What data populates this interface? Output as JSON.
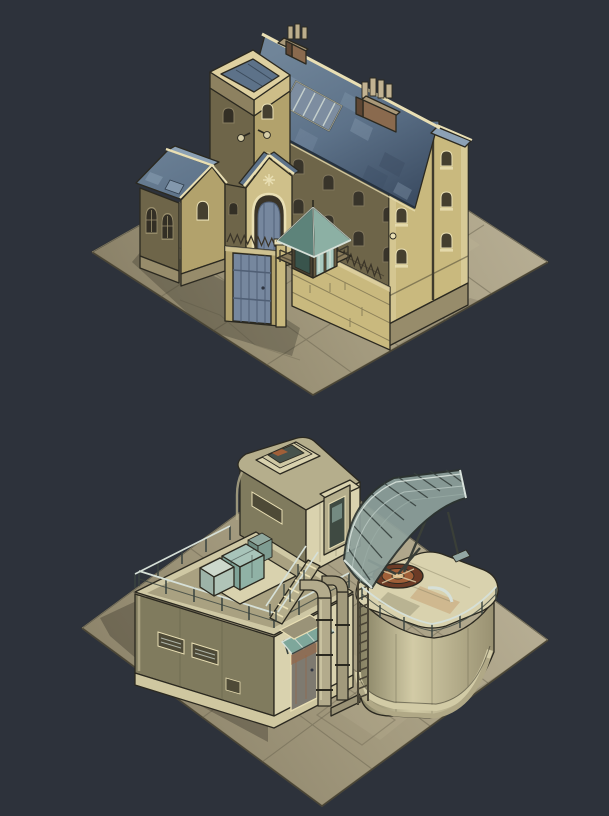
{
  "canvas": {
    "width": 609,
    "height": 816,
    "background": "#2d323b"
  },
  "palette": {
    "bg": "#2d323b",
    "ground_light": "#b9b096",
    "ground_mid": "#a39a7e",
    "ground_dark": "#8a8168",
    "ground_line": "#6b6450",
    "shadow": "#23211b",
    "wall_lit": "#c9b97e",
    "wall_mid": "#b2a26c",
    "wall_shadow": "#6e6549",
    "wall_dark": "#433e2e",
    "trim": "#e9dfb4",
    "stone": "#978c6b",
    "roof_hi": "#708599",
    "roof_light": "#8ca1b5",
    "roof_mid": "#5d7289",
    "roof_dark": "#3d4e64",
    "roof_line": "#26323f",
    "teal_roof": "#7ea79b",
    "teal_dark": "#54796f",
    "glass": "#a9c9bf",
    "gate": "#76879e",
    "gate_dark": "#505f75",
    "brick": "#8a6a4e",
    "brick_dark": "#5f4734",
    "khaki_lit": "#d9d2ae",
    "khaki_mid": "#b5ae8c",
    "khaki_shadow": "#807b5e",
    "khaki_dark": "#4e4a37",
    "tank_hi": "#d2cba6",
    "tank_lo": "#968e6f",
    "metal_light": "#d6e0d8",
    "metal_mid": "#93a7a3",
    "metal_dark": "#39433f",
    "rust": "#a05f38",
    "rust_dark": "#6c3b26",
    "crate": "#8fb3a9",
    "crate_dark": "#5d8076",
    "outline": "#2b2920"
  },
  "scenes": [
    {
      "id": "prison-building",
      "title": "Isometric prison building on a stone plaza",
      "parts": {
        "plaza": "Stone paved plaza",
        "main_hall": "Main cell block with slate gable roof",
        "tower": "Square tower with parapet roof",
        "annex": "Side annex with arched windows",
        "porch": "Arched entrance porch",
        "courtyard_wall": "Perimeter wall with barbed spikes",
        "gate": "Blue steel gate",
        "watchtower": "Corner guard post with glass cabin",
        "chimneys": "Brick chimney stacks",
        "skylight": "Metal roof skylight"
      }
    },
    {
      "id": "radar-station",
      "title": "Isometric industrial radar station on a paved yard",
      "parts": {
        "plaza": "Paved industrial yard",
        "bunker": "Rounded bunker with rooftop terrace",
        "module": "Upper control module with roof hatch",
        "tank": "Cylindrical storage tank",
        "antenna": "Curved radar antenna array",
        "pipes": "Industrial supply pipes",
        "ladder": "Service ladder",
        "stairs": "Terrace staircase",
        "crates": "Supply crates",
        "door": "Service door with teal awning"
      }
    }
  ]
}
